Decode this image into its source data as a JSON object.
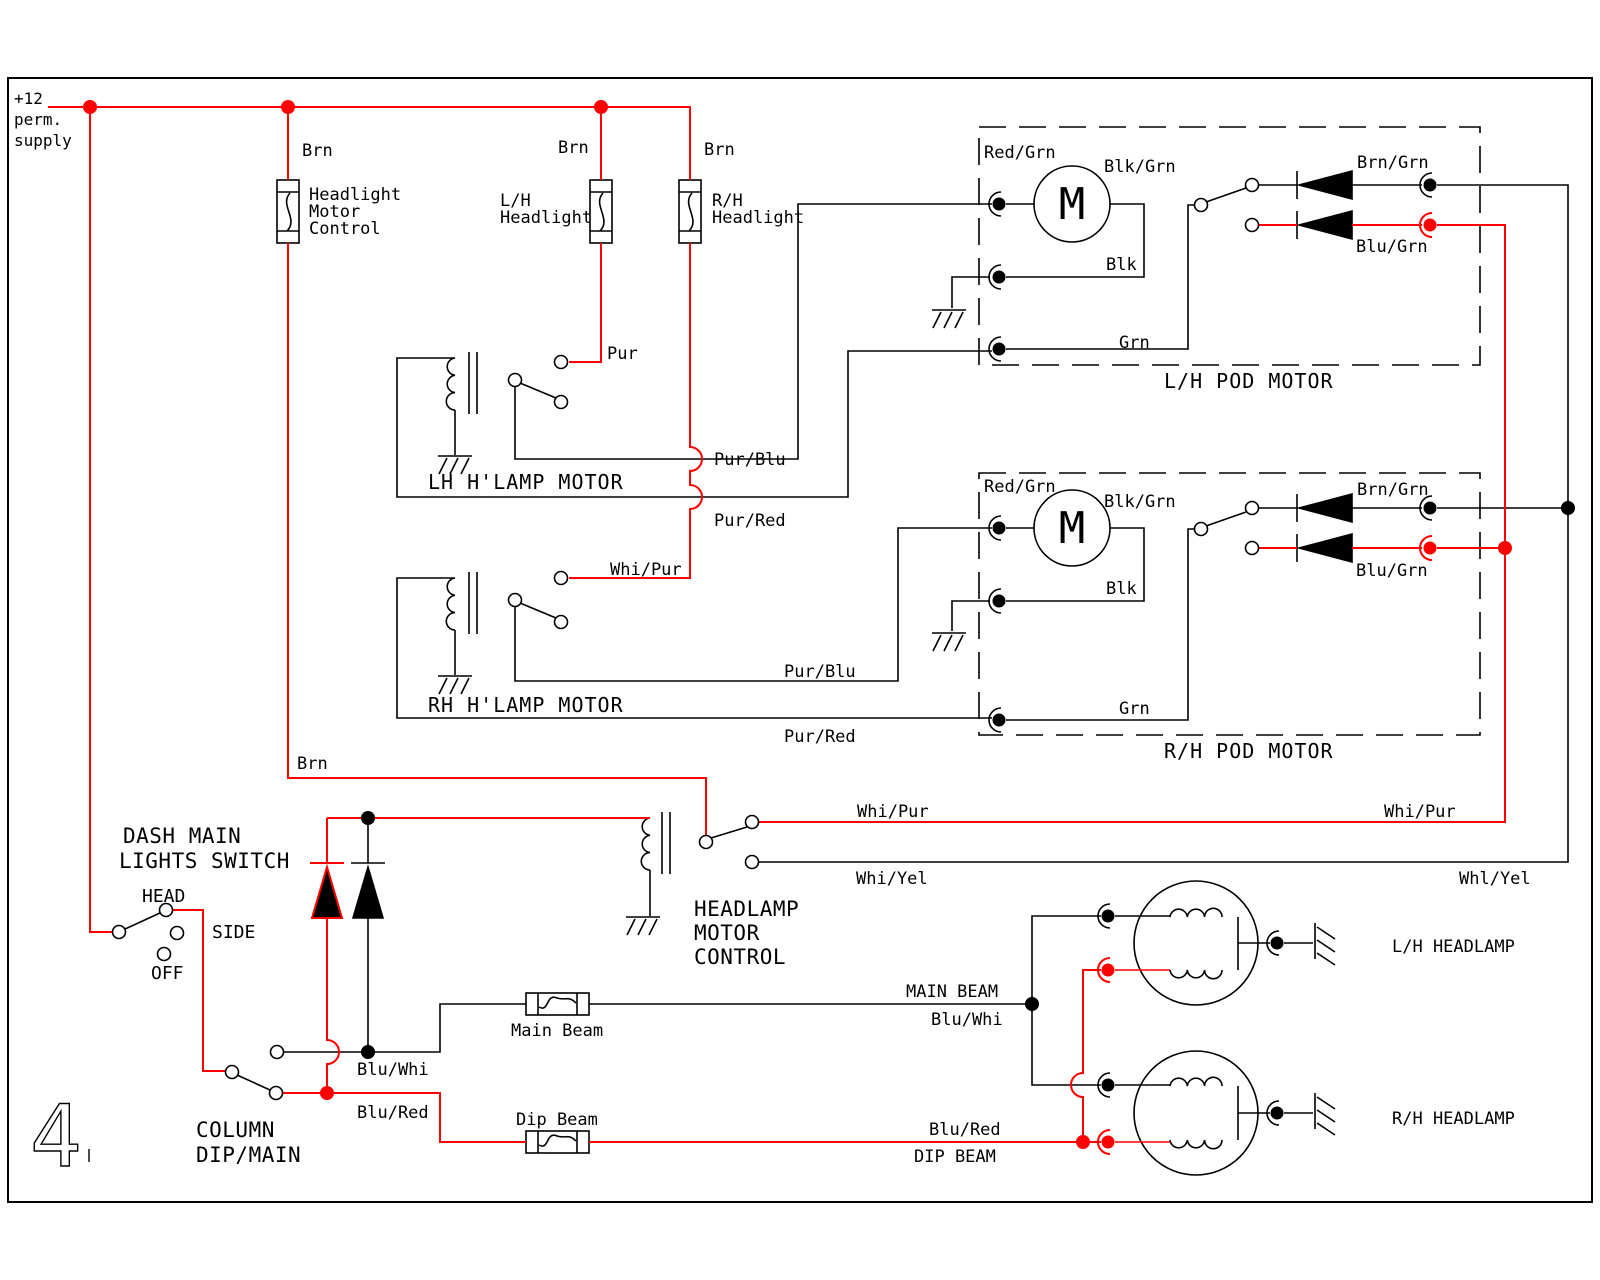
{
  "page": {
    "number": "4"
  },
  "colors": {
    "wire_red": "#ff0000",
    "wire_black": "#000000"
  },
  "supply": {
    "l1": "+12",
    "l2": "perm.",
    "l3": "supply"
  },
  "labels": {
    "brn1": "Brn",
    "brn2": "Brn",
    "brn3": "Brn",
    "brn4": "Brn",
    "pur": "Pur",
    "pur_blu_lh": "Pur/Blu",
    "pur_red_lh": "Pur/Red",
    "whi_pur_rh": "Whi/Pur",
    "pur_blu_rh": "Pur/Blu",
    "pur_red_rh": "Pur/Red",
    "whi_pur_l": "Whi/Pur",
    "whi_yel_l": "Whi/Yel",
    "whi_pur_r": "Whi/Pur",
    "whl_yel_r": "Whl/Yel",
    "blu_whi_col": "Blu/Whi",
    "blu_red_col": "Blu/Red",
    "main_beam": "MAIN BEAM",
    "blu_whi": "Blu/Whi",
    "blu_red": "Blu/Red",
    "dip_beam": "DIP BEAM"
  },
  "fuses": {
    "hmc1": "Headlight",
    "hmc2": "Motor",
    "hmc3": "Control",
    "lh1": "L/H",
    "lh2": "Headlight",
    "rh1": "R/H",
    "rh2": "Headlight",
    "main": "Main Beam",
    "dip": "Dip Beam"
  },
  "relays": {
    "lh": "LH H'LAMP MOTOR",
    "rh": "RH H'LAMP MOTOR",
    "c1": "HEADLAMP",
    "c2": "MOTOR",
    "c3": "CONTROL"
  },
  "dash_switch": {
    "t1": "DASH MAIN",
    "t2": "LIGHTS SWITCH",
    "head": "HEAD",
    "side": "SIDE",
    "off": "OFF"
  },
  "column_switch": {
    "t1": "COLUMN",
    "t2": "DIP/MAIN"
  },
  "pod_lh": {
    "title": "L/H POD MOTOR",
    "m": "M",
    "red_grn": "Red/Grn",
    "blk_grn": "Blk/Grn",
    "blk": "Blk",
    "grn": "Grn",
    "brn_grn": "Brn/Grn",
    "blu_grn": "Blu/Grn"
  },
  "pod_rh": {
    "title": "R/H POD MOTOR",
    "m": "M",
    "red_grn": "Red/Grn",
    "blk_grn": "Blk/Grn",
    "blk": "Blk",
    "grn": "Grn",
    "brn_grn": "Brn/Grn",
    "blu_grn": "Blu/Grn"
  },
  "headlamps": {
    "lh": "L/H HEADLAMP",
    "rh": "R/H HEADLAMP"
  }
}
